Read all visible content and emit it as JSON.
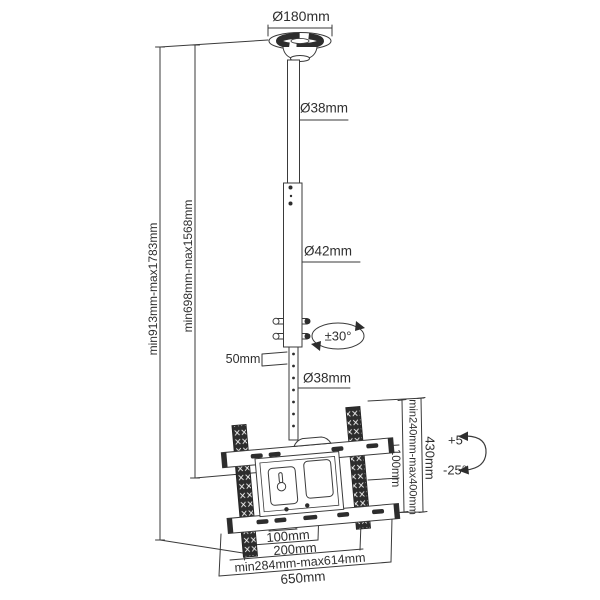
{
  "diagram": {
    "type": "technical-drawing",
    "subject": "Ceiling TV mount bracket dimension diagram",
    "colors": {
      "line": "#3a3a3a",
      "dark_fill": "#2d2d2d",
      "text": "#2f2f2f",
      "background": "#ffffff"
    },
    "labels": {
      "plate_diameter": "Ø180mm",
      "upper_pole_diameter": "Ø38mm",
      "middle_pole_diameter": "Ø42mm",
      "swivel_range": "±30°",
      "hole_spacing": "50mm",
      "lower_pole_diameter": "Ø38mm",
      "total_height_range": "min913mm-max1783mm",
      "pole_height_range": "min698mm-max1568mm",
      "vesa_height_range": "min240mm-max400mm",
      "vesa_vertical_pitch": "100mm",
      "bracket_height": "430mm",
      "tilt_up": "+5°",
      "tilt_down": "-25°",
      "vesa_horizontal_pitch": "100mm",
      "vesa_horizontal_max": "200mm",
      "arm_span_range": "min284mm-max614mm",
      "rail_width": "650mm"
    }
  }
}
